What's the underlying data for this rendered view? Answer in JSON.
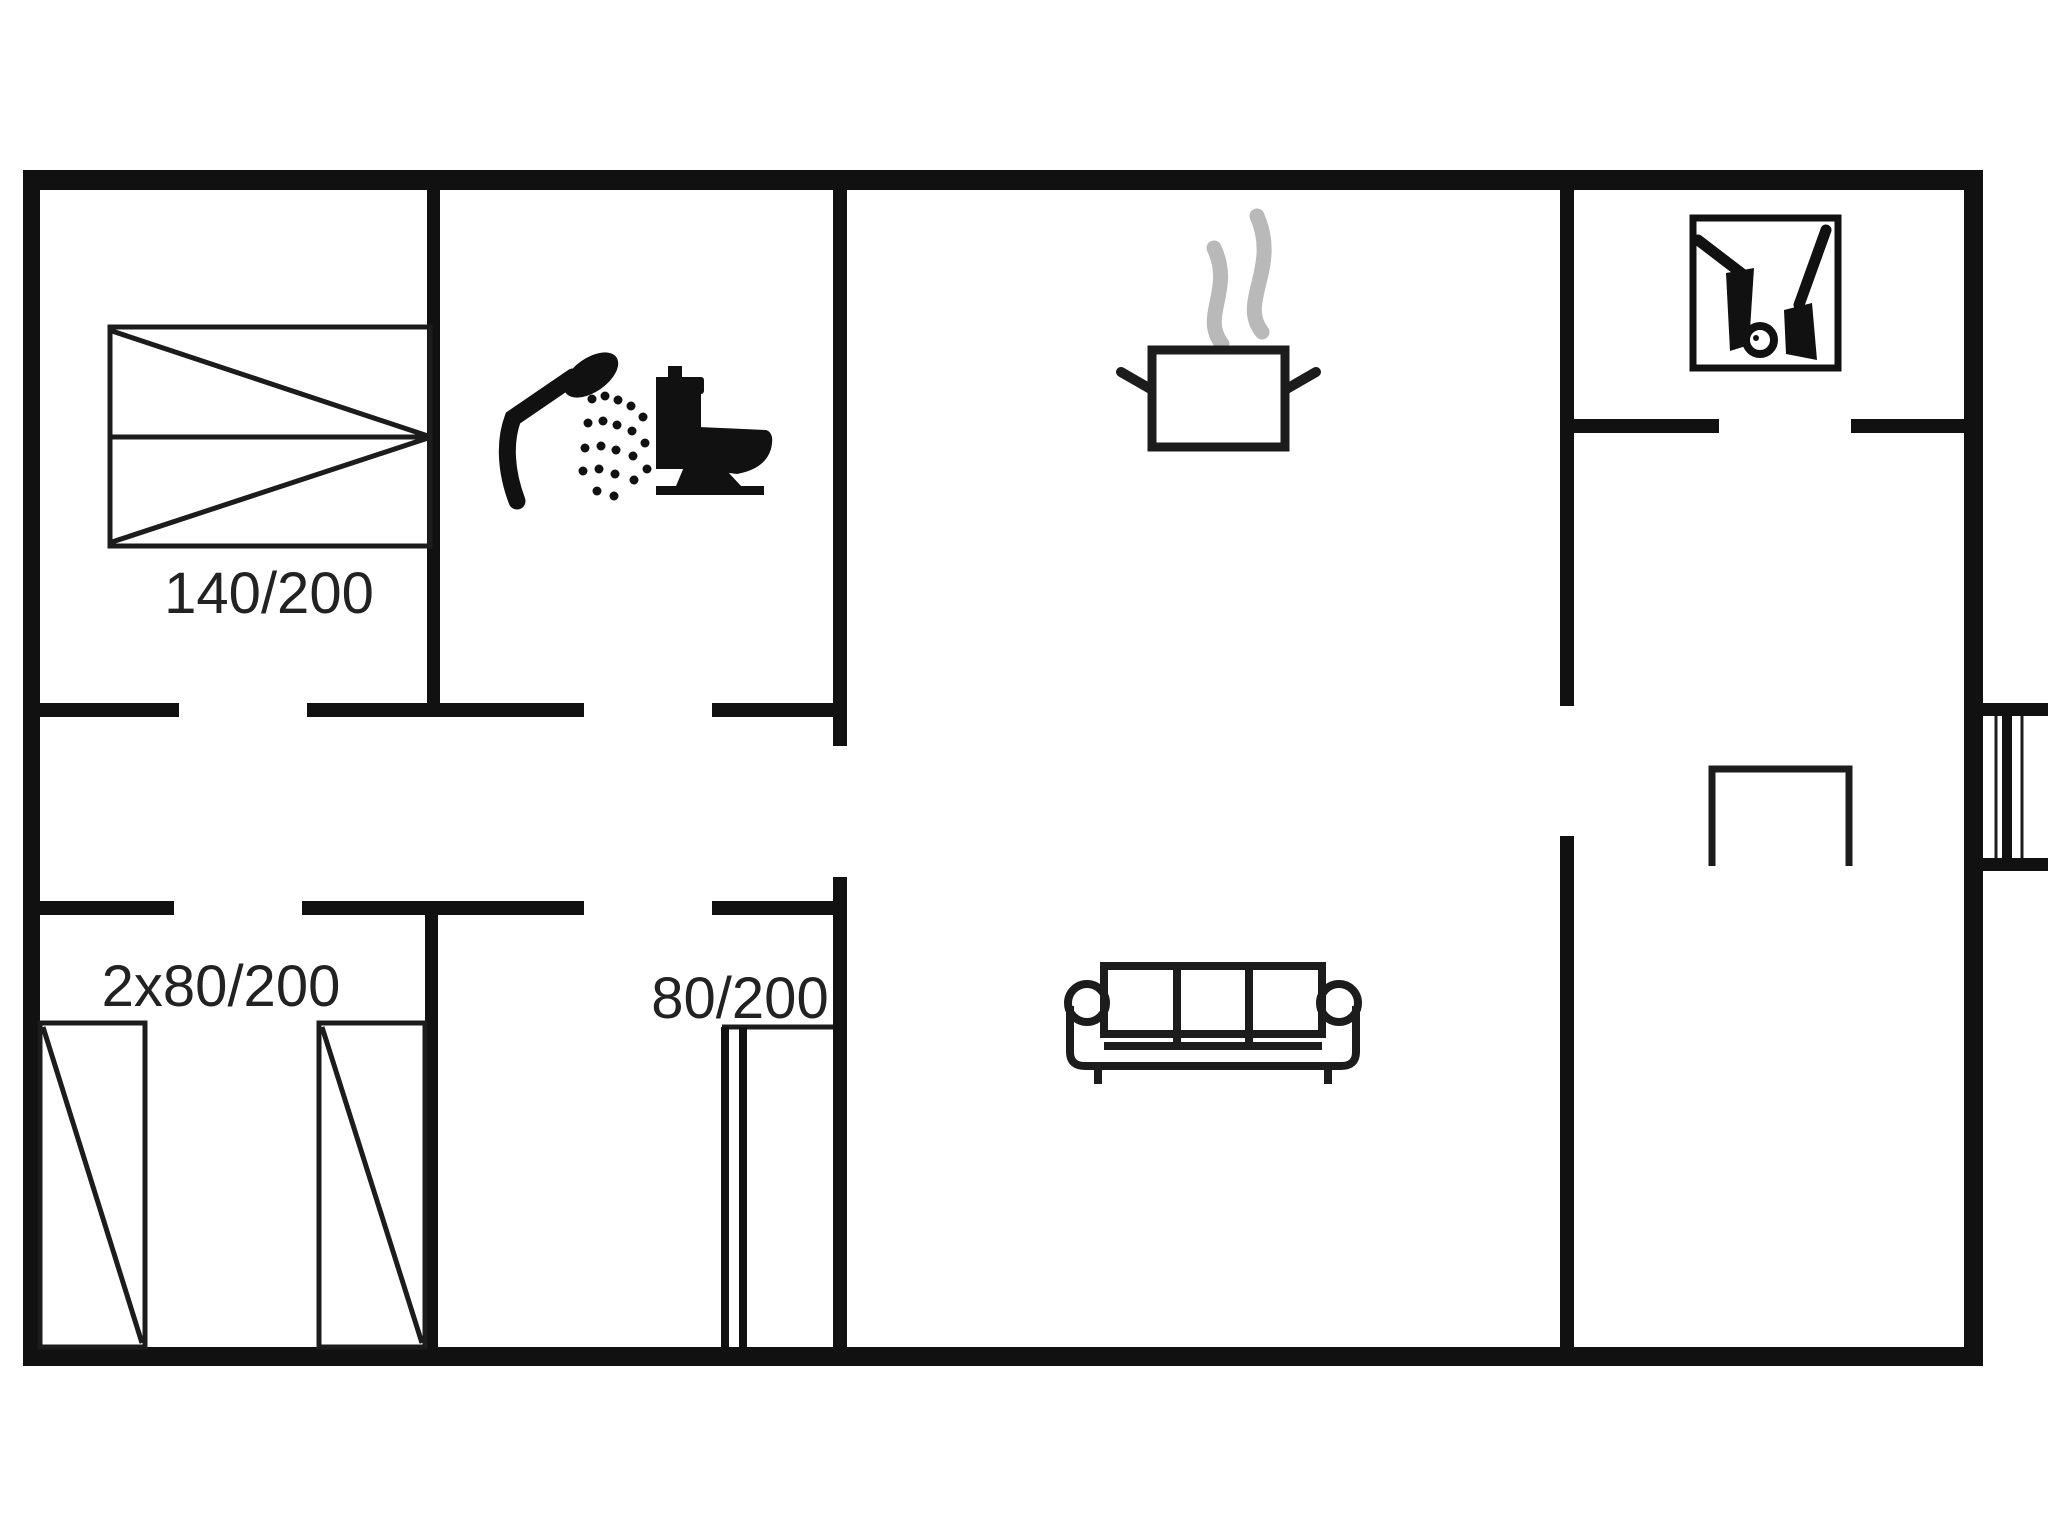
{
  "plan": {
    "colors": {
      "background": "#ffffff",
      "wall": "#111111",
      "line": "#1c1c1c",
      "steam": "#b9b9b9",
      "text": "#222222"
    },
    "labels": {
      "double_bed": "140/200",
      "twin_beds": "2x80/200",
      "single_bed": "80/200"
    },
    "icons": [
      {
        "name": "double-bed-icon"
      },
      {
        "name": "single-bed-icon"
      },
      {
        "name": "shower-icon"
      },
      {
        "name": "toilet-icon"
      },
      {
        "name": "cooking-pot-icon"
      },
      {
        "name": "steam-icon"
      },
      {
        "name": "fireplace-tools-icon"
      },
      {
        "name": "sofa-icon"
      },
      {
        "name": "table-icon"
      },
      {
        "name": "chimney-icon"
      }
    ]
  }
}
